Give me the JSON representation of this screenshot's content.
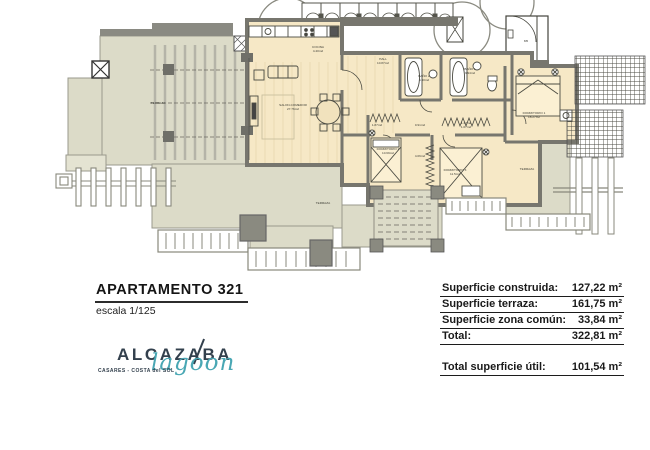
{
  "title_block": {
    "title": "APARTAMENTO 321",
    "scale_label": "escala 1/125"
  },
  "logo": {
    "brand": "ALCAZABA",
    "script": "lagoon",
    "tagline": "CASARES - COSTA del SOL",
    "brand_color": "#33404d",
    "script_color": "#49a7b4"
  },
  "area_table": {
    "rows": [
      {
        "label": "Superficie construida:",
        "value": "127,22 m²"
      },
      {
        "label": "Superficie terraza:",
        "value": "161,75 m²"
      },
      {
        "label": "Superficie zona común:",
        "value": "33,84 m²"
      },
      {
        "label": "Total:",
        "value": "322,81 m²"
      }
    ],
    "total_row": {
      "label": "Total superficie útil:",
      "value": "101,54 m²"
    }
  },
  "plan": {
    "colors": {
      "terrace_fill": "#dcdbc8",
      "interior_fill": "#f6e8c6",
      "wall": "#77766e",
      "line": "#4b4b42"
    },
    "labels": [
      {
        "x": 318,
        "y": 48,
        "t": "COCINA"
      },
      {
        "x": 318,
        "y": 52,
        "t": "4.40m2"
      },
      {
        "x": 383,
        "y": 60,
        "t": "HALL"
      },
      {
        "x": 383,
        "y": 64,
        "t": "10.87m2"
      },
      {
        "x": 424,
        "y": 77,
        "t": "BAÑO 2"
      },
      {
        "x": 424,
        "y": 81,
        "t": "4.30m2"
      },
      {
        "x": 470,
        "y": 70,
        "t": "BAÑO 1"
      },
      {
        "x": 470,
        "y": 74,
        "t": "3.94m2"
      },
      {
        "x": 293,
        "y": 106,
        "t": "SALON-COMEDOR"
      },
      {
        "x": 293,
        "y": 110,
        "t": "27.76m2"
      },
      {
        "x": 534,
        "y": 114,
        "t": "DORMITORIO 1"
      },
      {
        "x": 534,
        "y": 118,
        "t": "18.27m2"
      },
      {
        "x": 388,
        "y": 150,
        "t": "DORMITORIO 2"
      },
      {
        "x": 388,
        "y": 154,
        "t": "10.69m2"
      },
      {
        "x": 455,
        "y": 171,
        "t": "DORMITORIO 3"
      },
      {
        "x": 455,
        "y": 175,
        "t": "11.5m2"
      },
      {
        "x": 377,
        "y": 126,
        "t": "1.87m2"
      },
      {
        "x": 420,
        "y": 126,
        "t": "0.91m2"
      },
      {
        "x": 466,
        "y": 124,
        "t": "1.47m2"
      },
      {
        "x": 466,
        "y": 128,
        "t": "1.07m2"
      },
      {
        "x": 420,
        "y": 157,
        "t": "4.06m2"
      },
      {
        "x": 323,
        "y": 204,
        "t": "TERRAZA"
      },
      {
        "x": 158,
        "y": 104,
        "t": "TERRAZA"
      },
      {
        "x": 527,
        "y": 170,
        "t": "TERRAZA"
      },
      {
        "x": 526,
        "y": 42,
        "t": "M5"
      }
    ]
  }
}
